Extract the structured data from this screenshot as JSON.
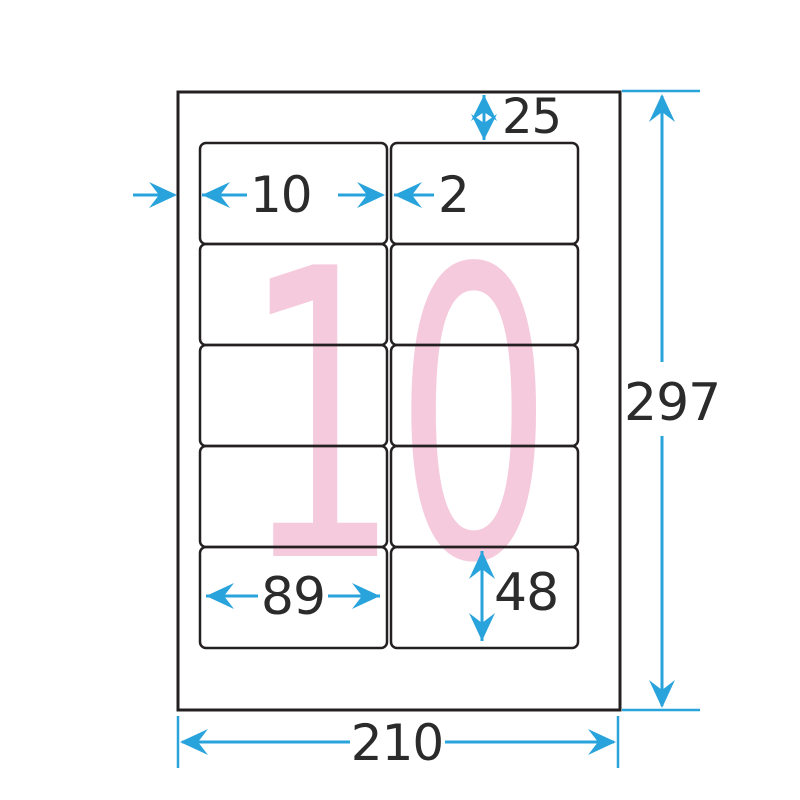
{
  "diagram": {
    "description": "Label sheet dimension diagram, 10 labels per sheet",
    "watermark_count": "10",
    "grid": {
      "rows": 5,
      "columns": 2,
      "label_count": 10
    },
    "dims": {
      "top_margin": "25",
      "side_margin": "10",
      "column_gap": "2",
      "label_width": "89",
      "label_height": "48",
      "sheet_height": "297",
      "sheet_width": "210"
    },
    "colors": {
      "arrow_blue": "#29A3DC",
      "watermark_pink": "#F6CADD",
      "line_black": "#242021"
    }
  }
}
